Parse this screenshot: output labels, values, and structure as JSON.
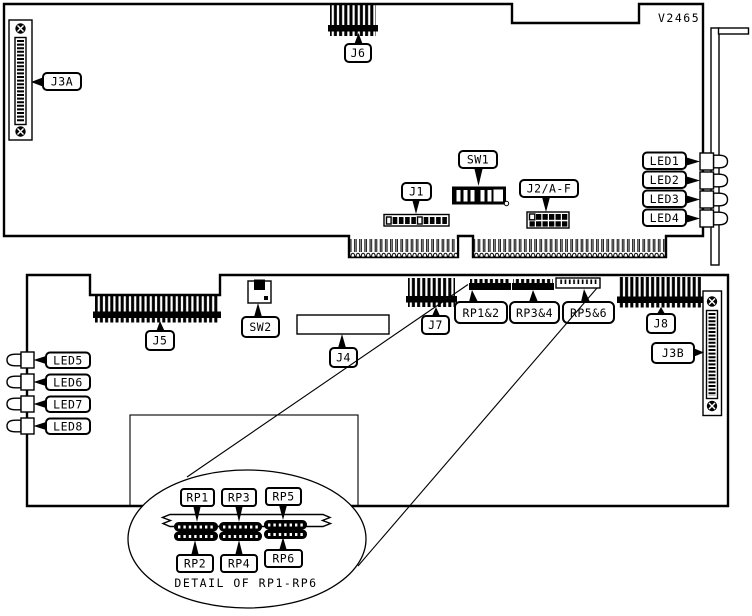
{
  "page": {
    "background": "#ffffff",
    "line_color": "#000000"
  },
  "board_code": "V2465",
  "upper_board": {
    "connectors": {
      "j3a": "J3A",
      "j6": "J6",
      "j1": "J1",
      "j2af": "J2/A-F"
    },
    "switches": {
      "sw1": "SW1"
    },
    "leds": {
      "led1": "LED1",
      "led2": "LED2",
      "led3": "LED3",
      "led4": "LED4"
    }
  },
  "lower_board": {
    "connectors": {
      "j5": "J5",
      "j4": "J4",
      "j7": "J7",
      "j8": "J8",
      "j3b": "J3B"
    },
    "switches": {
      "sw2": "SW2"
    },
    "resistor_packs": {
      "rp12": "RP1&2",
      "rp34": "RP3&4",
      "rp56": "RP5&6"
    },
    "leds": {
      "led5": "LED5",
      "led6": "LED6",
      "led7": "LED7",
      "led8": "LED8"
    }
  },
  "detail": {
    "caption": "DETAIL OF RP1-RP6",
    "labels": {
      "rp1": "RP1",
      "rp2": "RP2",
      "rp3": "RP3",
      "rp4": "RP4",
      "rp5": "RP5",
      "rp6": "RP6"
    }
  }
}
